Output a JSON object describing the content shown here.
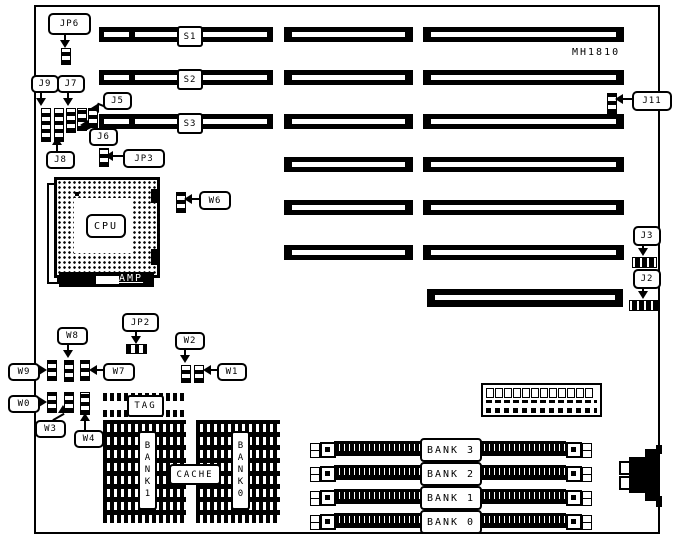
{
  "board": {
    "model": "MH1810"
  },
  "slots": {
    "s1": "S1",
    "s2": "S2",
    "s3": "S3"
  },
  "callouts": {
    "jp6": "JP6",
    "j9": "J9",
    "j7": "J7",
    "j5": "J5",
    "j6": "J6",
    "j8": "J8",
    "jp3": "JP3",
    "w6": "W6",
    "j11": "J11",
    "j3": "J3",
    "j2": "J2",
    "jp2": "JP2",
    "w8": "W8",
    "w9": "W9",
    "w7": "W7",
    "w2": "W2",
    "w1": "W1",
    "w0": "W0",
    "w3": "W3",
    "w4": "W4"
  },
  "cpu": {
    "label": "CPU",
    "brand": "AMP"
  },
  "cache": {
    "tag": "TAG",
    "label": "CACHE",
    "bank1": "BANK1",
    "bank0": "BANK0"
  },
  "memory_banks": [
    {
      "label": "BANK 3"
    },
    {
      "label": "BANK 2"
    },
    {
      "label": "BANK 1"
    },
    {
      "label": "BANK 0"
    }
  ]
}
